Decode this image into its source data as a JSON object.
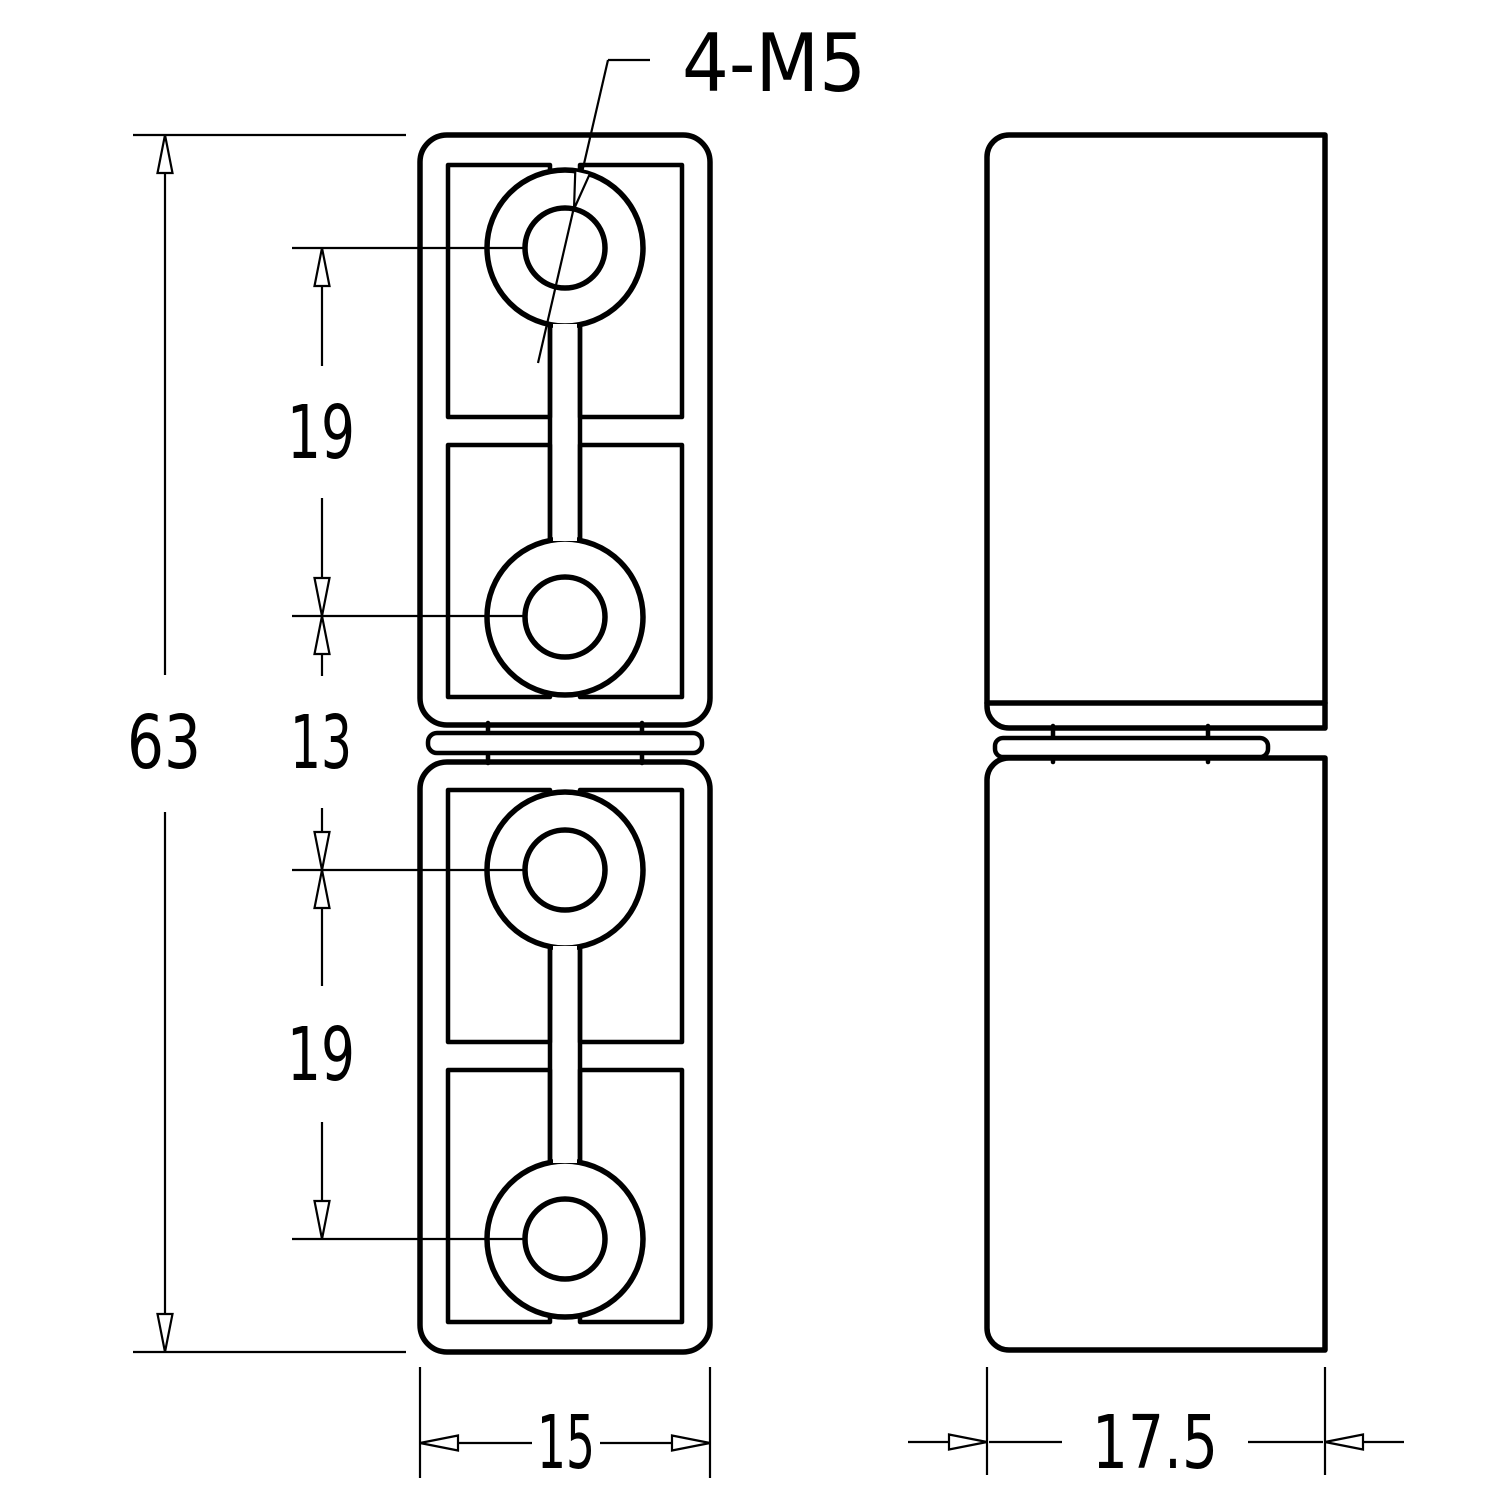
{
  "drawing": {
    "type": "technical-drawing",
    "part": "hinge-two-views",
    "colors": {
      "line": "#000000",
      "background": "#ffffff"
    },
    "labels": {
      "thread_callout": "4-M5"
    },
    "dimensions": {
      "overall_height": "63",
      "upper_hole_pitch": "19",
      "center_gap": "13",
      "lower_hole_pitch": "19",
      "front_width": "15",
      "side_width": "17.5"
    }
  }
}
